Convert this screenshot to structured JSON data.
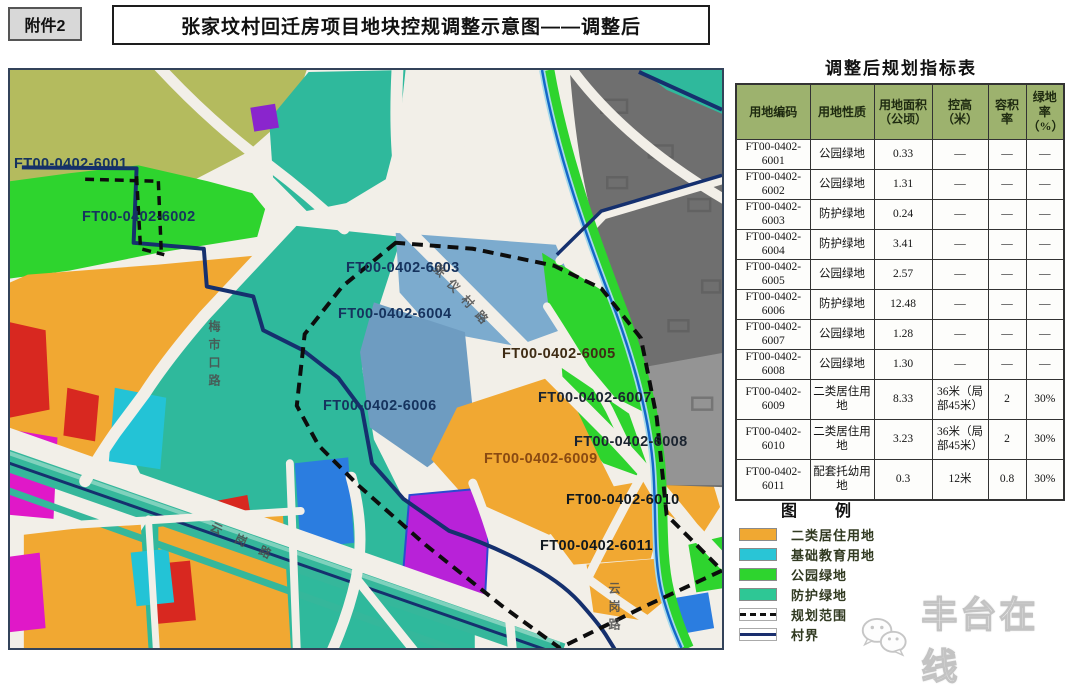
{
  "page": {
    "attachment_label": "附件2",
    "title": "张家坟村回迁房项目地块控规调整示意图——调整后",
    "watermark_text": "丰台在线"
  },
  "table": {
    "title": "调整后规划指标表",
    "headers": [
      "用地编码",
      "用地性质",
      "用地面积（公顷）",
      "控高（米）",
      "容积率",
      "绿地率（%）"
    ],
    "rows": [
      [
        "FT00-0402-6001",
        "公园绿地",
        "0.33",
        "—",
        "—",
        "—"
      ],
      [
        "FT00-0402-6002",
        "公园绿地",
        "1.31",
        "—",
        "—",
        "—"
      ],
      [
        "FT00-0402-6003",
        "防护绿地",
        "0.24",
        "—",
        "—",
        "—"
      ],
      [
        "FT00-0402-6004",
        "防护绿地",
        "3.41",
        "—",
        "—",
        "—"
      ],
      [
        "FT00-0402-6005",
        "公园绿地",
        "2.57",
        "—",
        "—",
        "—"
      ],
      [
        "FT00-0402-6006",
        "防护绿地",
        "12.48",
        "—",
        "—",
        "—"
      ],
      [
        "FT00-0402-6007",
        "公园绿地",
        "1.28",
        "—",
        "—",
        "—"
      ],
      [
        "FT00-0402-6008",
        "公园绿地",
        "1.30",
        "—",
        "—",
        "—"
      ],
      [
        "FT00-0402-6009",
        "二类居住用地",
        "8.33",
        "36米（局部45米）",
        "2",
        "30%"
      ],
      [
        "FT00-0402-6010",
        "二类居住用地",
        "3.23",
        "36米（局部45米）",
        "2",
        "30%"
      ],
      [
        "FT00-0402-6011",
        "配套托幼用地",
        "0.3",
        "12米",
        "0.8",
        "30%"
      ]
    ]
  },
  "legend": {
    "title": "图　　例",
    "items": [
      {
        "label": "二类居住用地",
        "type": "swatch",
        "color": "#f0a832"
      },
      {
        "label": "基础教育用地",
        "type": "swatch",
        "color": "#29c5d6"
      },
      {
        "label": "公园绿地",
        "type": "swatch",
        "color": "#2ed42e"
      },
      {
        "label": "防护绿地",
        "type": "swatch",
        "color": "#2ec795"
      },
      {
        "label": "规划范围",
        "type": "dashed-line",
        "color": "#111111"
      },
      {
        "label": "村界",
        "type": "solid-line",
        "color": "#1a2f6e"
      }
    ]
  },
  "map": {
    "plot_labels": [
      {
        "text": "FT00-0402-6001",
        "color": "#16335e"
      },
      {
        "text": "FT00-0402-6002",
        "color": "#16335e"
      },
      {
        "text": "FT00-0402-6003",
        "color": "#16335e"
      },
      {
        "text": "FT00-0402-6004",
        "color": "#16335e"
      },
      {
        "text": "FT00-0402-6005",
        "color": "#3f2c14"
      },
      {
        "text": "FT00-0402-6006",
        "color": "#16335e"
      },
      {
        "text": "FT00-0402-6007",
        "color": "#1b2430"
      },
      {
        "text": "FT00-0402-6008",
        "color": "#1b2430"
      },
      {
        "text": "FT00-0402-6009",
        "color": "#8a4a12"
      },
      {
        "text": "FT00-0402-6010",
        "color": "#10181f"
      },
      {
        "text": "FT00-0402-6011",
        "color": "#10181f"
      }
    ],
    "road_labels": [
      {
        "text": "张仪村路"
      },
      {
        "text": "梅市口路"
      },
      {
        "text": "云岗路"
      },
      {
        "text": "云岗路"
      }
    ]
  }
}
